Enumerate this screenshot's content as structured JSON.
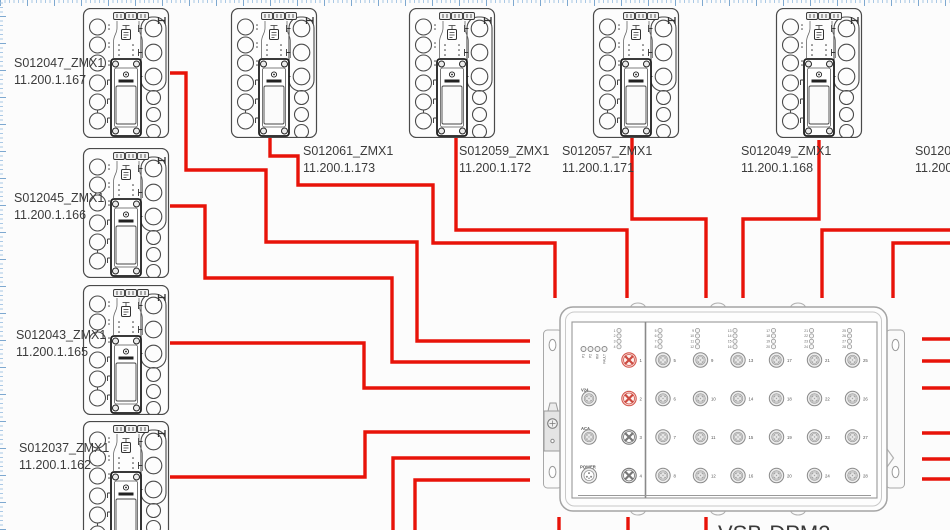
{
  "app": {
    "background": "#fcfcfc",
    "grid_color": "#a9c8e5",
    "wire_color": "#e81309",
    "label_color": "#3c3c3c"
  },
  "devices": [
    {
      "label": "S012047_ZMX1",
      "ip": "11.200.1.167"
    },
    {
      "label": "S012045_ZMX1",
      "ip": "11.200.1.166"
    },
    {
      "label": "S012043_ZMX1",
      "ip": "11.200.1.165"
    },
    {
      "label": "S012037_ZMX1",
      "ip": "11.200.1.162"
    },
    {
      "label": "S012061_ZMX1",
      "ip": "11.200.1.173"
    },
    {
      "label": "S012059_ZMX1",
      "ip": "11.200.1.172"
    },
    {
      "label": "S012057_ZMX1",
      "ip": "11.200.1.171"
    },
    {
      "label": "S012049_ZMX1",
      "ip": "11.200.1.168"
    },
    {
      "label": "S012053",
      "ip": "11.200.1"
    }
  ],
  "dpm": {
    "title": "VSB-DPM2",
    "status_leds": [
      "P1",
      "P2",
      "RM",
      "FAULT"
    ],
    "aux": {
      "v24": "V24",
      "aca": "ACA",
      "power": "POWER"
    },
    "left_ports": [
      {
        "num": "1",
        "style": "red"
      },
      {
        "num": "2",
        "style": "red"
      },
      {
        "num": "3",
        "style": "gray"
      },
      {
        "num": "4",
        "style": "gray"
      }
    ],
    "columns": [
      [
        "5",
        "6",
        "7",
        "8"
      ],
      [
        "9",
        "10",
        "11",
        "12"
      ],
      [
        "13",
        "14",
        "15",
        "16"
      ],
      [
        "17",
        "18",
        "19",
        "20"
      ],
      [
        "21",
        "22",
        "23",
        "24"
      ],
      [
        "25",
        "26",
        "27",
        "28"
      ]
    ]
  },
  "icons": {
    "h_marker": "H",
    "port_connector": "m12-circle",
    "red_port": "fan-wheel",
    "power_connector": "pin-circle"
  }
}
